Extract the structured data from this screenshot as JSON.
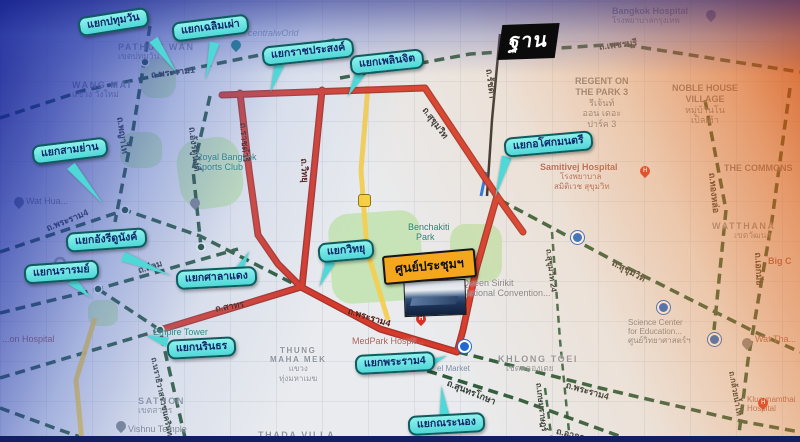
{
  "watermark": {
    "text": "ฐาน"
  },
  "highlight": {
    "label": "ศูนย์ประชุมฯ"
  },
  "callouts": [
    {
      "label": "แยกปทุมวัน"
    },
    {
      "label": "แยกเฉลิมเผ่า"
    },
    {
      "label": "แยกราชประสงค์"
    },
    {
      "label": "แยกเพลินจิต"
    },
    {
      "label": "แยกสามย่าน"
    },
    {
      "label": "แยกอังรีดูนังค์"
    },
    {
      "label": "แยกนรารมย์"
    },
    {
      "label": "แยกศาลาแดง"
    },
    {
      "label": "แยกวิทยุ"
    },
    {
      "label": "แยกนรินธร"
    },
    {
      "label": "แยกพระราม4"
    },
    {
      "label": "แยกณระนอง"
    },
    {
      "label": "แยกอโศกมนตรี"
    }
  ],
  "road_labels": [
    {
      "text": "ถ.พระราม1"
    },
    {
      "text": "ถ.พญาไท"
    },
    {
      "text": "ถ.อังรีดูนังต์"
    },
    {
      "text": "ถ.ราชดำริ"
    },
    {
      "text": "ถ.วิทยุ"
    },
    {
      "text": "ถ.สีลม"
    },
    {
      "text": "ถ.สาทร"
    },
    {
      "text": "ถ.พระราม4"
    },
    {
      "text": "ถ.พระราม4"
    },
    {
      "text": "ถ.พระราม4"
    },
    {
      "text": "ถ.นราธิวาสราชนครินทร์"
    },
    {
      "text": "ถ.เพชรบุรี"
    },
    {
      "text": "ถ.รัชดา"
    },
    {
      "text": "ถ.สุขุมวิท"
    },
    {
      "text": "ถ.สุขุมวิท"
    },
    {
      "text": "ถ.สุขุมวิท 24"
    },
    {
      "text": "ถ.ทองหล่อ"
    },
    {
      "text": "ถ.เอกมัย"
    },
    {
      "text": "ถ.กล้วยน้ำไท"
    },
    {
      "text": "ถ.สุนทรโกษา"
    },
    {
      "text": "ถ.เกษมราษฎร์"
    },
    {
      "text": "ถ.อาจณรงค์"
    }
  ],
  "districts": [
    {
      "lines": [
        "PATHUM WAN",
        "เขตปทุมวัน"
      ]
    },
    {
      "lines": [
        "WANG MAI",
        "แขวง วังใหม่"
      ]
    },
    {
      "lines": [
        "WATTHANA",
        "เขตวัฒนา"
      ]
    },
    {
      "lines": [
        "KHLONG TOEI",
        "เขตคลองเตย"
      ]
    },
    {
      "lines": [
        "THUNG",
        "MAHA MEK",
        "แขวง",
        "ทุ่งมหาเมฆ"
      ]
    },
    {
      "lines": [
        "SATHON",
        "เขตสาทร"
      ]
    },
    {
      "lines": [
        "THADA VILLA"
      ]
    }
  ],
  "places": [
    {
      "lines": [
        "centralwOrld"
      ]
    },
    {
      "lines": [
        "Royal Bangkok",
        "Sports Club"
      ]
    },
    {
      "lines": [
        "Bangkok Hospital",
        "โรงพยาบาลกรุงเทพ"
      ]
    },
    {
      "lines": [
        "REGENT ON",
        "THE PARK 3",
        "รีเจ้นท์",
        "ออน เดอะ",
        "ปาร์ค 3"
      ]
    },
    {
      "lines": [
        "NOBLE HOUSE",
        "VILLAGE",
        "หมู่บ้านโน",
        "เบิลเฮ้า"
      ]
    },
    {
      "lines": [
        "Samitivej Hospital",
        "โรงพยาบาล",
        "สมิติเวช สุขุมวิท"
      ]
    },
    {
      "lines": [
        "THE COMMONS"
      ]
    },
    {
      "lines": [
        "Big C"
      ]
    },
    {
      "lines": [
        "Benchakiti",
        "Park"
      ]
    },
    {
      "lines": [
        "Queen Sirikit",
        "National Convention..."
      ]
    },
    {
      "lines": [
        "MedPark Hospit..."
      ]
    },
    {
      "lines": [
        "el Market"
      ]
    },
    {
      "lines": [
        "Empire Tower"
      ]
    },
    {
      "lines": [
        "Vishnu Temple"
      ]
    },
    {
      "lines": [
        "Wat Hua..."
      ]
    },
    {
      "lines": [
        "...on Hospital"
      ]
    },
    {
      "lines": [
        "Science Center",
        "for Education...",
        "ศูนย์วิทยาศาสตร์ฯ"
      ]
    },
    {
      "lines": [
        "Wat Tha..."
      ]
    },
    {
      "lines": [
        "Kluaynamthai",
        "Hospital"
      ]
    }
  ],
  "icons": {
    "hospital_letter": "H"
  },
  "colors": {
    "route_highlight": "#d63a2b",
    "road_dashed_green": "#1d4f2c",
    "expressway_yellow": "#f3cf4f",
    "callout_bg": "#63e6e6",
    "callout_border": "#0d5c60",
    "callout_text": "#10286b",
    "highlight_bg": "#f4a71d",
    "overlay_blue": "#101c92",
    "overlay_orange": "#d24600",
    "footer_bar": "#131f63"
  }
}
